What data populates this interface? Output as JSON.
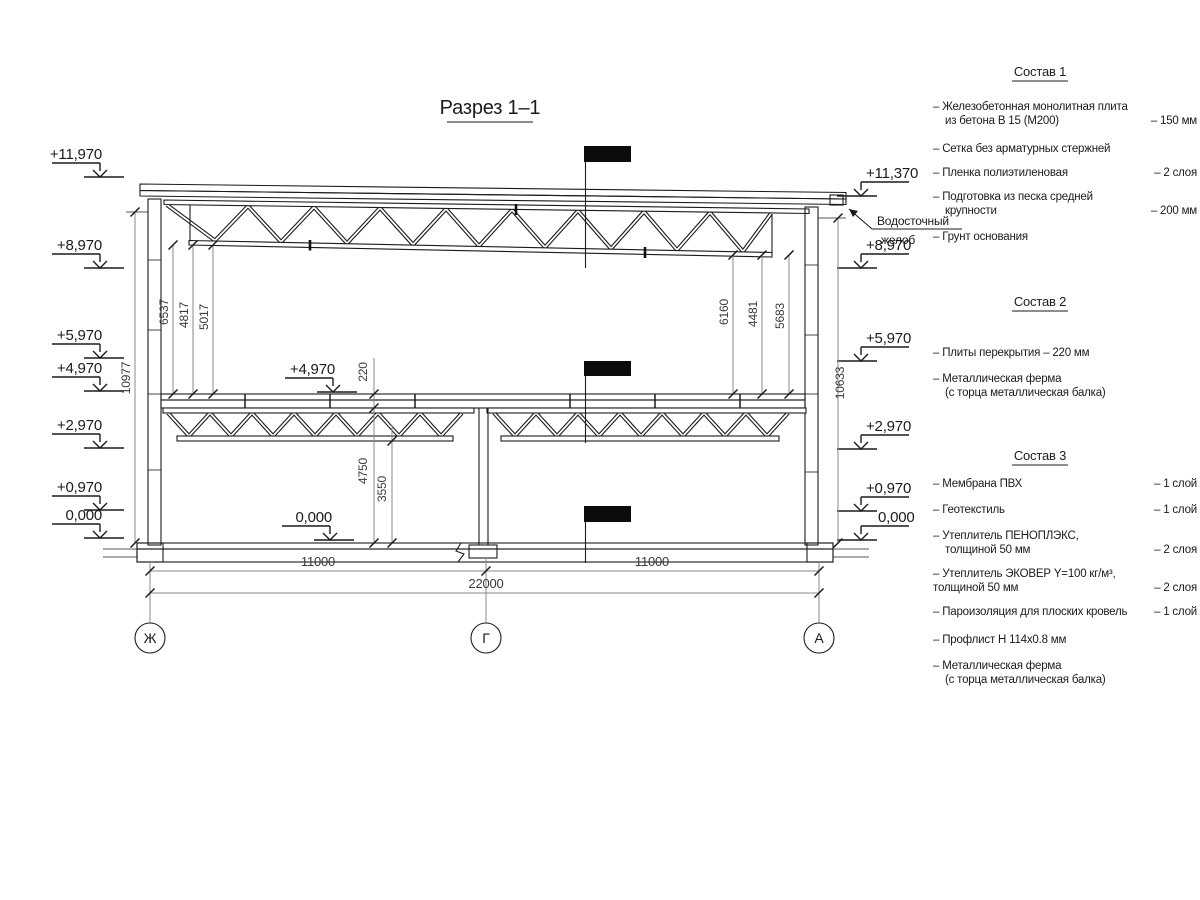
{
  "title": "Разрез 1–1",
  "section": {
    "gutter1": "Водосточный",
    "gutter2": "желоб"
  },
  "elev": {
    "l0": "+11,970",
    "l1": "+8,970",
    "l2": "+5,970",
    "l3": "+4,970",
    "l4": "+2,970",
    "l5": "+0,970",
    "l6": "0,000",
    "r0": "+11,370",
    "r1": "+8,970",
    "r2": "+5,970",
    "r3": "+2,970",
    "r4": "+0,970",
    "r5": "0,000",
    "c0": "+4,970",
    "c1": "0,000"
  },
  "dims": {
    "height_left": "10977",
    "height_right": "10633",
    "il0": "6537",
    "il1": "4817",
    "il2": "5017",
    "ir0": "6160",
    "ir1": "4481",
    "ir2": "5683",
    "slab": "220",
    "floor_a": "4750",
    "floor_b": "3550",
    "span_l": "11000",
    "span_r": "11000",
    "total": "22000"
  },
  "grid": {
    "g0": "Ж",
    "g1": "Г",
    "g2": "А"
  },
  "notes": {
    "s1": {
      "title": "Состав 1",
      "i1a": "– Железобетонная монолитная плита",
      "i1b": "из бетона В 15 (М200)",
      "v1": "– 150 мм",
      "i2": "– Сетка без арматурных стержней",
      "i3": "– Пленка полиэтиленовая",
      "v3": "– 2 слоя",
      "i4a": "– Подготовка из песка средней",
      "i4b": "крупности",
      "v4": "– 200 мм",
      "i5": "– Грунт основания"
    },
    "s2": {
      "title": "Состав 2",
      "i1": "– Плиты перекрытия – 220 мм",
      "i2a": "– Металлическая ферма",
      "i2b": "(с торца металлическая балка)"
    },
    "s3": {
      "title": "Состав 3",
      "i1": "– Мембрана ПВХ",
      "v1": "– 1 слой",
      "i2": "– Геотекстиль",
      "v2": "– 1 слой",
      "i3a": "– Утеплитель ПЕНОПЛЭКС,",
      "i3b": "толщиной 50 мм",
      "v3": "– 2 слоя",
      "i4a": "– Утеплитель ЭКОВЕР Y=100 кг/м³,",
      "i4b": "толщиной 50 мм",
      "v4": "– 2 слоя",
      "i5": "– Пароизоляция для плоских кровель",
      "v5": "– 1 слой",
      "i6": "– Профлист Н 114х0.8 мм",
      "i7a": "– Металлическая ферма",
      "i7b": "(с торца металлическая балка)"
    }
  }
}
